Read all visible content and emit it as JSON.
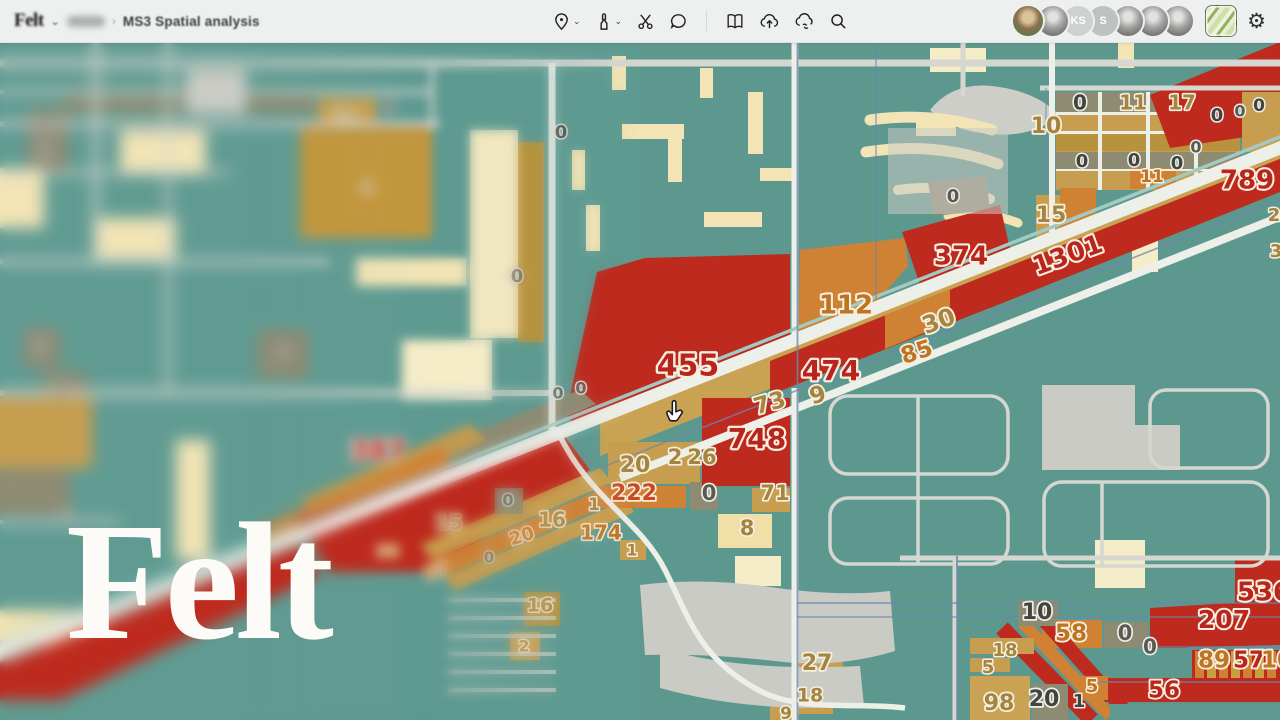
{
  "header": {
    "logo_text": "Felt",
    "workspace_chevron": "⌄",
    "breadcrumb_separator": "›",
    "map_title": "MS3 Spatial analysis",
    "settings_glyph": "⚙"
  },
  "toolbar": {
    "icons": [
      "location-pin-tool",
      "annotation-marker-tool",
      "cut-tool",
      "comment-tool",
      "pages-tool",
      "upload-cloud-tool",
      "cloud-link-tool",
      "search-tool"
    ]
  },
  "presence": {
    "avatars": [
      {
        "style": "photo-color",
        "initials": ""
      },
      {
        "style": "photo-gray",
        "initials": ""
      },
      {
        "style": "init-a",
        "initials": "KS"
      },
      {
        "style": "init-b",
        "initials": "S"
      },
      {
        "style": "photo-gray",
        "initials": ""
      },
      {
        "style": "photo-gray",
        "initials": ""
      },
      {
        "style": "photo-gray",
        "initials": ""
      }
    ]
  },
  "watermark": {
    "text": "Felt"
  },
  "map": {
    "palette": {
      "teal": "#5E9A91",
      "road_minor": "#D5D7D0",
      "road_major": "#EDEFE9",
      "parking": "#C9CBC4",
      "beige": "#F2E4B5",
      "pale": "#F5ECC8",
      "tan": "#C79E4F",
      "gold": "#B8933E",
      "olive": "#8E8B73",
      "orange": "#D08234",
      "red": "#BE2A1E",
      "slate": "#6E86AC",
      "transit": "#A2CAC3"
    },
    "label_styles": {
      "red": {
        "fill": "#B8251C",
        "stroke": "#F7EEDF"
      },
      "org": {
        "fill": "#BE7420",
        "stroke": "#F7EEDF"
      },
      "ored": {
        "fill": "#C84A1E",
        "stroke": "#F7EEDF"
      },
      "tan": {
        "fill": "#A3853F",
        "stroke": "#F7EEDF"
      },
      "gry": {
        "fill": "#5A5A52",
        "stroke": "#EDEEE8"
      },
      "drk": {
        "fill": "#44443E",
        "stroke": "#EDEEE8"
      }
    },
    "labels": [
      {
        "v": "0",
        "x": 47,
        "y": 128,
        "c": "gry",
        "s": 15
      },
      {
        "v": "0",
        "x": 44,
        "y": 152,
        "c": "gry",
        "s": 14
      },
      {
        "v": "0",
        "x": 40,
        "y": 347,
        "c": "gry",
        "s": 15
      },
      {
        "v": "0",
        "x": 62,
        "y": 390,
        "c": "gry",
        "s": 15
      },
      {
        "v": "0",
        "x": 66,
        "y": 517,
        "c": "gry",
        "s": 15
      },
      {
        "v": "14",
        "x": 345,
        "y": 116,
        "c": "tan",
        "s": 17
      },
      {
        "v": "0",
        "x": 389,
        "y": 107,
        "c": "drk",
        "s": 16
      },
      {
        "v": "4",
        "x": 367,
        "y": 188,
        "c": "tan",
        "s": 19
      },
      {
        "v": "8",
        "x": 283,
        "y": 353,
        "c": "gry",
        "s": 17
      },
      {
        "v": "0",
        "x": 517,
        "y": 277,
        "c": "gry",
        "s": 18
      },
      {
        "v": "0",
        "x": 561,
        "y": 133,
        "c": "drk",
        "s": 18
      },
      {
        "v": "0",
        "x": 953,
        "y": 197,
        "c": "gry",
        "s": 18
      },
      {
        "v": "455",
        "x": 688,
        "y": 367,
        "c": "red",
        "s": 30
      },
      {
        "v": "474",
        "x": 831,
        "y": 372,
        "c": "red",
        "s": 28
      },
      {
        "v": "748",
        "x": 757,
        "y": 440,
        "c": "red",
        "s": 28
      },
      {
        "v": "387",
        "x": 378,
        "y": 452,
        "c": "red",
        "s": 27
      },
      {
        "v": "73",
        "x": 770,
        "y": 404,
        "c": "tan",
        "s": 23,
        "r": -16
      },
      {
        "v": "9",
        "x": 818,
        "y": 396,
        "c": "tan",
        "s": 23,
        "r": -16
      },
      {
        "v": "85",
        "x": 917,
        "y": 353,
        "c": "org",
        "s": 23,
        "r": -18
      },
      {
        "v": "30",
        "x": 939,
        "y": 322,
        "c": "tan",
        "s": 24,
        "r": -20
      },
      {
        "v": "112",
        "x": 846,
        "y": 306,
        "c": "org",
        "s": 26
      },
      {
        "v": "374",
        "x": 961,
        "y": 257,
        "c": "red",
        "s": 26
      },
      {
        "v": "1301",
        "x": 1068,
        "y": 256,
        "c": "red",
        "s": 26,
        "r": -20
      },
      {
        "v": "15",
        "x": 1051,
        "y": 216,
        "c": "tan",
        "s": 22
      },
      {
        "v": "789",
        "x": 1247,
        "y": 181,
        "c": "red",
        "s": 26
      },
      {
        "v": "10",
        "x": 1046,
        "y": 127,
        "c": "tan",
        "s": 22
      },
      {
        "v": "0",
        "x": 1080,
        "y": 104,
        "c": "drk",
        "s": 20
      },
      {
        "v": "11",
        "x": 1133,
        "y": 104,
        "c": "tan",
        "s": 20
      },
      {
        "v": "17",
        "x": 1182,
        "y": 104,
        "c": "tan",
        "s": 20
      },
      {
        "v": "0",
        "x": 1082,
        "y": 162,
        "c": "drk",
        "s": 18
      },
      {
        "v": "0",
        "x": 1134,
        "y": 161,
        "c": "drk",
        "s": 18
      },
      {
        "v": "0",
        "x": 1177,
        "y": 164,
        "c": "drk",
        "s": 18
      },
      {
        "v": "11",
        "x": 1152,
        "y": 177,
        "c": "org",
        "s": 17
      },
      {
        "v": "0",
        "x": 1196,
        "y": 148,
        "c": "gry",
        "s": 16
      },
      {
        "v": "0",
        "x": 1217,
        "y": 116,
        "c": "drk",
        "s": 18
      },
      {
        "v": "0",
        "x": 1240,
        "y": 112,
        "c": "gry",
        "s": 16
      },
      {
        "v": "0",
        "x": 1259,
        "y": 106,
        "c": "drk",
        "s": 17
      },
      {
        "v": "2",
        "x": 1274,
        "y": 216,
        "c": "tan",
        "s": 18
      },
      {
        "v": "3",
        "x": 1276,
        "y": 252,
        "c": "tan",
        "s": 18
      },
      {
        "v": "0",
        "x": 558,
        "y": 394,
        "c": "gry",
        "s": 16
      },
      {
        "v": "0",
        "x": 581,
        "y": 389,
        "c": "gry",
        "s": 16
      },
      {
        "v": "20",
        "x": 635,
        "y": 466,
        "c": "tan",
        "s": 22
      },
      {
        "v": "2",
        "x": 675,
        "y": 458,
        "c": "tan",
        "s": 21
      },
      {
        "v": "26",
        "x": 702,
        "y": 458,
        "c": "tan",
        "s": 21
      },
      {
        "v": "222",
        "x": 634,
        "y": 494,
        "c": "ored",
        "s": 22
      },
      {
        "v": "0",
        "x": 709,
        "y": 494,
        "c": "gry",
        "s": 21
      },
      {
        "v": "71",
        "x": 775,
        "y": 494,
        "c": "tan",
        "s": 21
      },
      {
        "v": "8",
        "x": 747,
        "y": 529,
        "c": "tan",
        "s": 21
      },
      {
        "v": "1",
        "x": 632,
        "y": 551,
        "c": "tan",
        "s": 16
      },
      {
        "v": "0",
        "x": 508,
        "y": 501,
        "c": "gry",
        "s": 16
      },
      {
        "v": "15",
        "x": 449,
        "y": 524,
        "c": "tan",
        "s": 20
      },
      {
        "v": "16",
        "x": 552,
        "y": 521,
        "c": "tan",
        "s": 20
      },
      {
        "v": "1",
        "x": 594,
        "y": 505,
        "c": "tan",
        "s": 17
      },
      {
        "v": "174",
        "x": 601,
        "y": 534,
        "c": "org",
        "s": 20
      },
      {
        "v": "20",
        "x": 522,
        "y": 537,
        "c": "org",
        "s": 18,
        "r": -18
      },
      {
        "v": "87",
        "x": 437,
        "y": 572,
        "c": "org",
        "s": 18,
        "r": -14
      },
      {
        "v": "30",
        "x": 388,
        "y": 552,
        "c": "org",
        "s": 16
      },
      {
        "v": "0",
        "x": 489,
        "y": 558,
        "c": "gry",
        "s": 15
      },
      {
        "v": "16",
        "x": 540,
        "y": 606,
        "c": "tan",
        "s": 19
      },
      {
        "v": "2",
        "x": 524,
        "y": 647,
        "c": "tan",
        "s": 16
      },
      {
        "v": "27",
        "x": 817,
        "y": 664,
        "c": "tan",
        "s": 22
      },
      {
        "v": "18",
        "x": 810,
        "y": 696,
        "c": "tan",
        "s": 19
      },
      {
        "v": "9",
        "x": 786,
        "y": 714,
        "c": "tan",
        "s": 17
      },
      {
        "v": "10",
        "x": 1037,
        "y": 613,
        "c": "drk",
        "s": 22
      },
      {
        "v": "58",
        "x": 1071,
        "y": 634,
        "c": "org",
        "s": 23
      },
      {
        "v": "0",
        "x": 1125,
        "y": 634,
        "c": "gry",
        "s": 21
      },
      {
        "v": "0",
        "x": 1150,
        "y": 648,
        "c": "gry",
        "s": 20
      },
      {
        "v": "207",
        "x": 1224,
        "y": 621,
        "c": "red",
        "s": 25
      },
      {
        "v": "536",
        "x": 1264,
        "y": 593,
        "c": "red",
        "s": 26
      },
      {
        "v": "89",
        "x": 1214,
        "y": 661,
        "c": "org",
        "s": 23
      },
      {
        "v": "57",
        "x": 1249,
        "y": 661,
        "c": "red",
        "s": 23
      },
      {
        "v": "10",
        "x": 1277,
        "y": 661,
        "c": "org",
        "s": 23
      },
      {
        "v": "56",
        "x": 1164,
        "y": 691,
        "c": "red",
        "s": 23
      },
      {
        "v": "5",
        "x": 1092,
        "y": 687,
        "c": "org",
        "s": 18
      },
      {
        "v": "18",
        "x": 1005,
        "y": 651,
        "c": "tan",
        "s": 18
      },
      {
        "v": "5",
        "x": 988,
        "y": 668,
        "c": "tan",
        "s": 18
      },
      {
        "v": "98",
        "x": 999,
        "y": 704,
        "c": "tan",
        "s": 22
      },
      {
        "v": "20",
        "x": 1044,
        "y": 700,
        "c": "drk",
        "s": 22
      },
      {
        "v": "1",
        "x": 1079,
        "y": 702,
        "c": "drk",
        "s": 18
      }
    ]
  }
}
